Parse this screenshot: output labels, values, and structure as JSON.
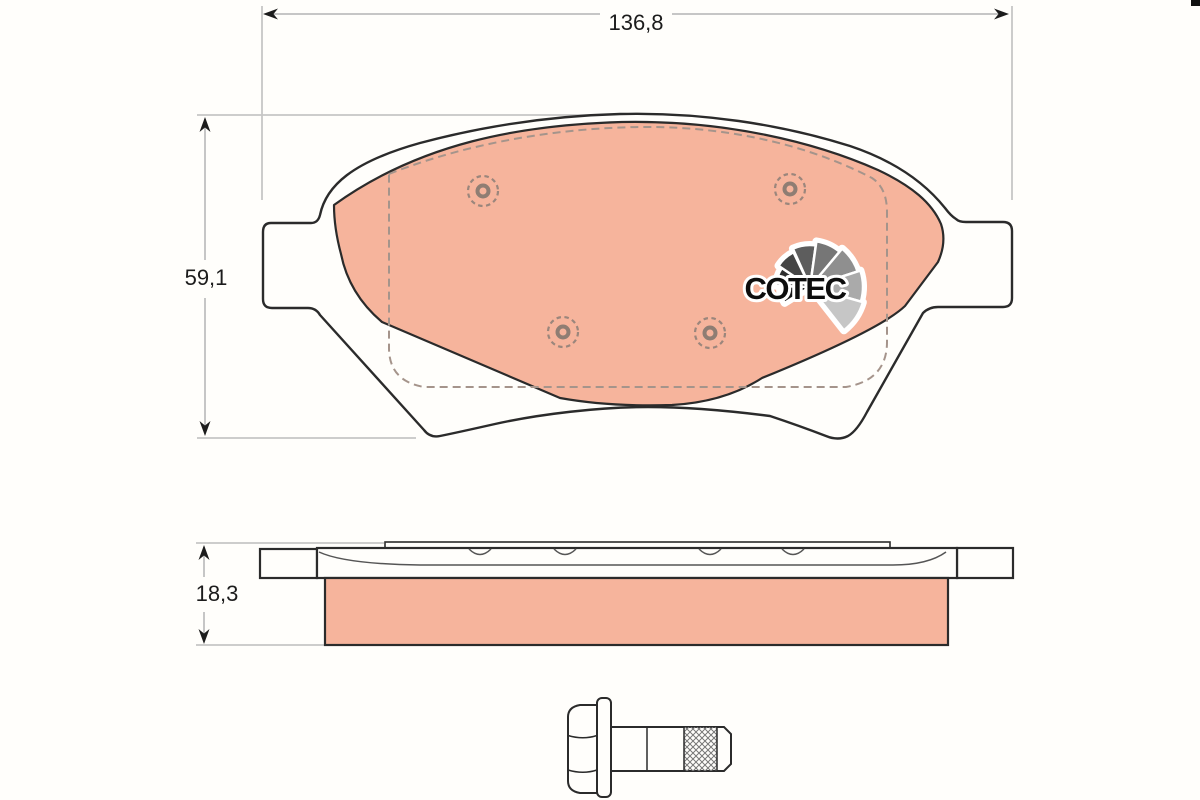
{
  "dimensions": {
    "width": "136,8",
    "height": "59,1",
    "thickness": "18,3"
  },
  "logo": {
    "text": "COTEC"
  },
  "colors": {
    "friction_material": "#f6b49c",
    "outline": "#2b2b2b",
    "dimension_line": "#c6c6c6",
    "hidden_line": "#a5948b",
    "rivet": "#9b867c",
    "background": "#fffefb"
  }
}
